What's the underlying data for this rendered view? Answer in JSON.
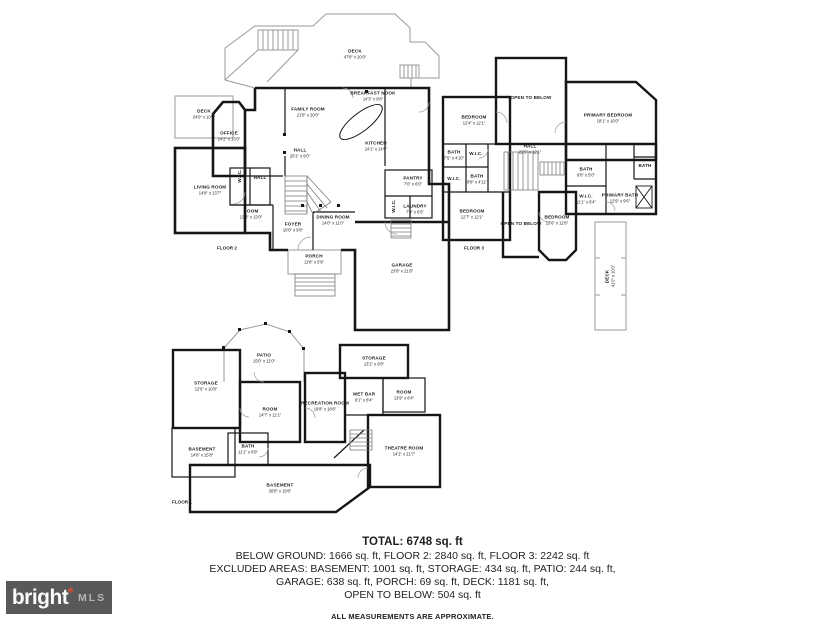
{
  "page": {
    "background": "#ffffff"
  },
  "plans": [
    {
      "id": "floor2",
      "floor_label": "FLOOR 2",
      "rooms": [
        {
          "name": "DECK",
          "dims": "47'8\" x 20'0\"",
          "x": 192,
          "y": 48
        },
        {
          "name": "DECK",
          "dims": "24'0\" x 10'0\"",
          "x": 41,
          "y": 108
        },
        {
          "name": "OFFICE",
          "dims": "14'2\" x 13'0\"",
          "x": 66,
          "y": 130
        },
        {
          "name": "FAMILY ROOM",
          "dims": "21'8\" x 20'0\"",
          "x": 145,
          "y": 106
        },
        {
          "name": "BREAKFAST NOOK",
          "dims": "14'3\" x 9'8\"",
          "x": 210,
          "y": 90
        },
        {
          "name": "KITCHEN",
          "dims": "24'1\" x 14'8\"",
          "x": 213,
          "y": 140
        },
        {
          "name": "LIVING ROOM",
          "dims": "14'8\" x 13'7\"",
          "x": 47,
          "y": 184
        },
        {
          "name": "HALL",
          "dims": "20'1\" x 9'0\"",
          "x": 137,
          "y": 147
        },
        {
          "name": "W.I.C.",
          "dims": "",
          "x": 77,
          "y": 170,
          "rot": 1
        },
        {
          "name": "HALL",
          "dims": "",
          "x": 97,
          "y": 172
        },
        {
          "name": "ROOM",
          "dims": "13'8\" x 13'0\"",
          "x": 88,
          "y": 208
        },
        {
          "name": "FOYER",
          "dims": "10'0\" x 9'8\"",
          "x": 130,
          "y": 221
        },
        {
          "name": "DINING ROOM",
          "dims": "14'0\" x 11'0\"",
          "x": 170,
          "y": 214
        },
        {
          "name": "PANTRY",
          "dims": "7'0\" x 6'0\"",
          "x": 250,
          "y": 175
        },
        {
          "name": "W.I.C.",
          "dims": "",
          "x": 231,
          "y": 200,
          "rot": 1
        },
        {
          "name": "LAUNDRY",
          "dims": "7'9\" x 6'5\"",
          "x": 252,
          "y": 203
        },
        {
          "name": "GARAGE",
          "dims": "23'8\" x 21'8\"",
          "x": 239,
          "y": 262
        },
        {
          "name": "PORCH",
          "dims": "11'8\" x 5'9\"",
          "x": 151,
          "y": 253
        }
      ]
    },
    {
      "id": "floor3",
      "floor_label": "FLOOR 3",
      "rooms": [
        {
          "name": "OPEN TO BELOW",
          "dims": "",
          "x": 93,
          "y": 46
        },
        {
          "name": "PRIMARY BEDROOM",
          "dims": "18'1\" x 16'0\"",
          "x": 170,
          "y": 66
        },
        {
          "name": "BEDROOM",
          "dims": "12'4\" x 12'1\"",
          "x": 36,
          "y": 68
        },
        {
          "name": "HALL",
          "dims": "22'5\" x 12'1\"",
          "x": 92,
          "y": 97
        },
        {
          "name": "BATH",
          "dims": "7'5\" x 4'10\"",
          "x": 16,
          "y": 103
        },
        {
          "name": "W.I.C.",
          "dims": "",
          "x": 38,
          "y": 102
        },
        {
          "name": "W.I.C.",
          "dims": "",
          "x": 16,
          "y": 127
        },
        {
          "name": "BATH",
          "dims": "8'8\" x 4'11\"",
          "x": 39,
          "y": 127
        },
        {
          "name": "BEDROOM",
          "dims": "12'7\" x 12'1\"",
          "x": 34,
          "y": 162
        },
        {
          "name": "OPEN TO BELOW",
          "dims": "",
          "x": 83,
          "y": 172
        },
        {
          "name": "BEDROOM",
          "dims": "13'6\" x 12'6\"",
          "x": 119,
          "y": 168
        },
        {
          "name": "BATH",
          "dims": "9'8\" x 5'0\"",
          "x": 148,
          "y": 120
        },
        {
          "name": "W.I.C.",
          "dims": "11'1\" x 6'4\"",
          "x": 148,
          "y": 147
        },
        {
          "name": "PRIMARY BATH",
          "dims": "12'9\" x 9'6\"",
          "x": 182,
          "y": 146
        },
        {
          "name": "BATH",
          "dims": "",
          "x": 207,
          "y": 114
        },
        {
          "name": "DECK",
          "dims": "41'0\" x 10'0\"",
          "x": 172,
          "y": 224,
          "rot": 1
        }
      ]
    },
    {
      "id": "floor1",
      "floor_label": "FLOOR 1",
      "rooms": [
        {
          "name": "PATIO",
          "dims": "15'0\" x 11'0\"",
          "x": 96,
          "y": 40
        },
        {
          "name": "STORAGE",
          "dims": "12'6\" x 10'8\"",
          "x": 38,
          "y": 68
        },
        {
          "name": "ROOM",
          "dims": "14'7\" x 11'1\"",
          "x": 102,
          "y": 94
        },
        {
          "name": "RECREATION ROOM",
          "dims": "19'8\" x 18'6\"",
          "x": 157,
          "y": 88
        },
        {
          "name": "STORAGE",
          "dims": "13'1\" x 9'8\"",
          "x": 206,
          "y": 43
        },
        {
          "name": "WET BAR",
          "dims": "9'1\" x 8'4\"",
          "x": 196,
          "y": 79
        },
        {
          "name": "ROOM",
          "dims": "13'9\" x 8'4\"",
          "x": 236,
          "y": 77
        },
        {
          "name": "THEATRE ROOM",
          "dims": "14'1\" x 21'7\"",
          "x": 236,
          "y": 133
        },
        {
          "name": "BASEMENT",
          "dims": "14'8\" x 15'8\"",
          "x": 34,
          "y": 134
        },
        {
          "name": "BATH",
          "dims": "11'1\" x 6'8\"",
          "x": 80,
          "y": 131
        },
        {
          "name": "BASEMENT",
          "dims": "30'8\" x 19'8\"",
          "x": 112,
          "y": 170
        }
      ]
    }
  ],
  "summary": {
    "total": "TOTAL: 6748 sq. ft",
    "line1": "BELOW GROUND: 1666 sq. ft, FLOOR 2: 2840 sq. ft, FLOOR 3: 2242 sq. ft",
    "line2": "EXCLUDED AREAS: BASEMENT: 1001 sq. ft, STORAGE: 434 sq. ft, PATIO: 244 sq. ft,",
    "line3": "GARAGE: 638 sq. ft, PORCH: 69 sq. ft, DECK: 1181 sq. ft,",
    "line4": "OPEN TO BELOW: 504 sq. ft",
    "disclaimer": "ALL MEASUREMENTS ARE APPROXIMATE."
  },
  "logo": {
    "brand": "bright",
    "mark": "✱",
    "suffix": "MLS",
    "bg_color": "#58595b",
    "brand_color": "#fbfbfb",
    "suffix_color": "#b5b6b8",
    "mark_color": "#cf4f2e"
  }
}
